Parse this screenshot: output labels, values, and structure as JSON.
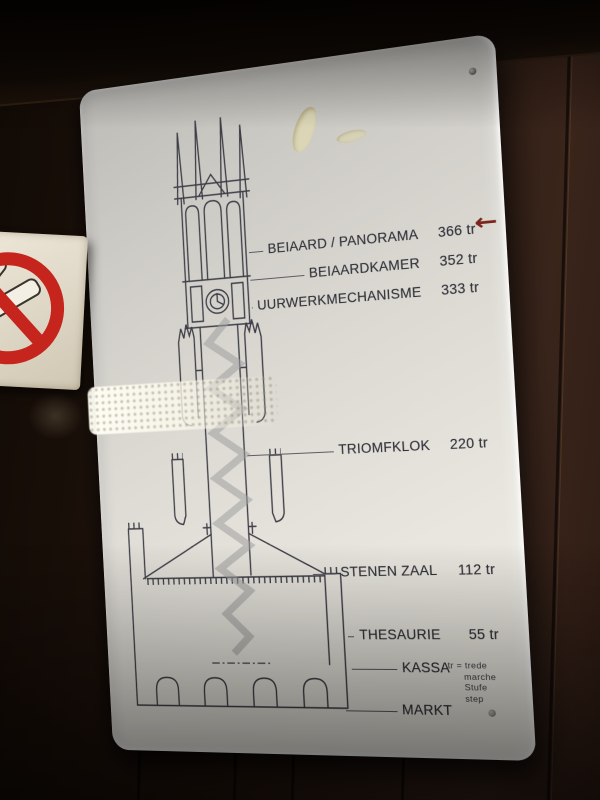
{
  "belfry_sign": {
    "levels": [
      {
        "name": "BEIAARD / PANORAMA",
        "steps": "366 tr",
        "has_arrow": true
      },
      {
        "name": "BEIAARDKAMER",
        "steps": "352 tr"
      },
      {
        "name": "UURWERKMECHANISME",
        "steps": "333 tr"
      },
      {
        "name": "TRIOMFKLOK",
        "steps": "220 tr"
      },
      {
        "name": "STENEN ZAAL",
        "steps": "112 tr"
      },
      {
        "name": "THESAURIE",
        "steps": "55 tr"
      },
      {
        "name": "KASSA",
        "steps": ""
      },
      {
        "name": "MARKT",
        "steps": ""
      }
    ],
    "legend": [
      "tr = trede",
      "marche",
      "Stufe",
      "step"
    ],
    "icons": {
      "direction_arrow": "←"
    },
    "colors": {
      "arrow": "#7b241c",
      "diagram_line": "#3e3e48",
      "staircase": "#9e9e9e",
      "sign_background": "#e4e2da"
    }
  },
  "no_smoking_sign": {
    "symbol": "no-smoking",
    "colors": {
      "ring": "#c5251d",
      "background": "#e4ddd0"
    }
  }
}
